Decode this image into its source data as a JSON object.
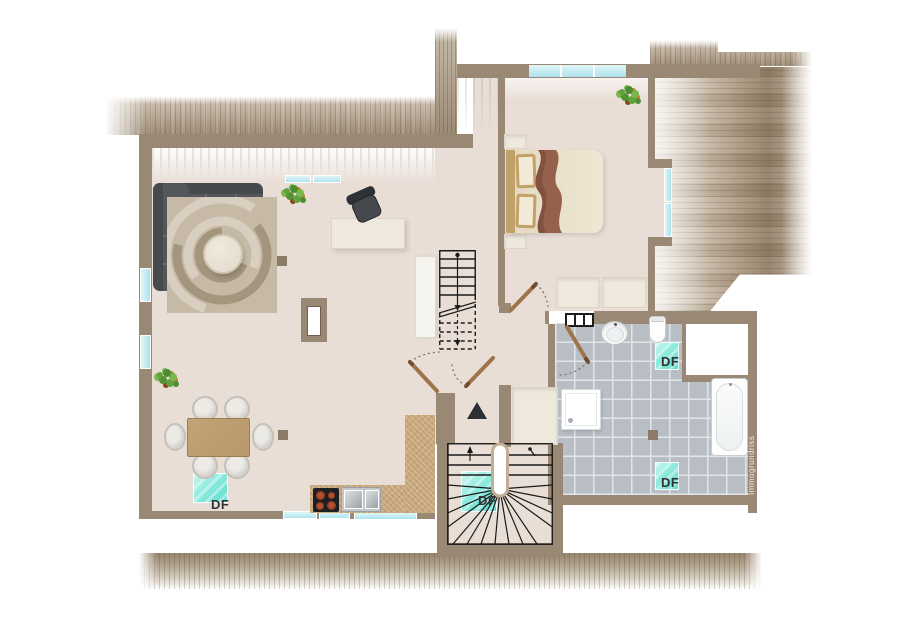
{
  "plan": {
    "type": "floor-plan",
    "watermark": "Immogrundriss",
    "skylights": {
      "label": "DF",
      "count": 4
    },
    "colors": {
      "floor": "#e9ded6",
      "wall": "#998874",
      "tile_floor": "#b8bec4",
      "tile_grout": "#e2e5e8",
      "window_glass": "#c3ebf2",
      "skylight_glass": "#5fdccd",
      "kitchen_counter": "#c9a87c",
      "sofa": "#53575b",
      "wood_furniture": "#b7986a",
      "rug": "#c6b9a5",
      "stair_line": "#1a1a1a",
      "label_text": "#333333",
      "roof_shade": "#9d8c77",
      "furniture_unit": "#efe9dd",
      "blanket": "#95604c"
    },
    "rooms": [
      "living-dining-kitchen",
      "bedroom",
      "bathroom",
      "hallway",
      "stair-vestibule"
    ],
    "fixtures": [
      "corner-sofa",
      "swirl-rug",
      "coffee-table",
      "desk",
      "office-chair",
      "chimney",
      "dining-table",
      "dining-chairs",
      "kitchen-counter",
      "cooktop",
      "double-sink",
      "double-bed",
      "nightstands",
      "wardrobes",
      "plants",
      "straight-staircase",
      "winder-staircase",
      "radiator",
      "washbasin",
      "toilet",
      "shower",
      "bathtub",
      "entrance-arrow",
      "roof-windows"
    ]
  }
}
